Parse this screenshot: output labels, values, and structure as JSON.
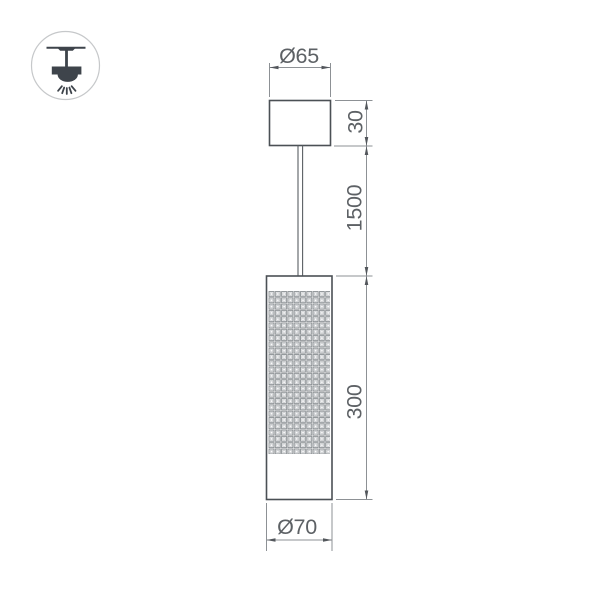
{
  "canvas": {
    "background": "#ffffff"
  },
  "icon": {
    "name": "ceiling-pendant-light-icon"
  },
  "drawing": {
    "type": "technical-dimension-drawing",
    "dimensions": {
      "canopy_diameter": {
        "label": "Ø65",
        "value": 65
      },
      "canopy_height": {
        "label": "30",
        "value": 30
      },
      "cable_length": {
        "label": "1500",
        "value": 1500
      },
      "body_height": {
        "label": "300",
        "value": 300
      },
      "body_diameter": {
        "label": "Ø70",
        "value": 70
      }
    },
    "colors": {
      "outline": "#4b5055",
      "dimension_line": "#8d9195",
      "dimension_text": "#5d6165",
      "icon_fill": "#3e444b",
      "mesh_line": "#898e92"
    }
  }
}
